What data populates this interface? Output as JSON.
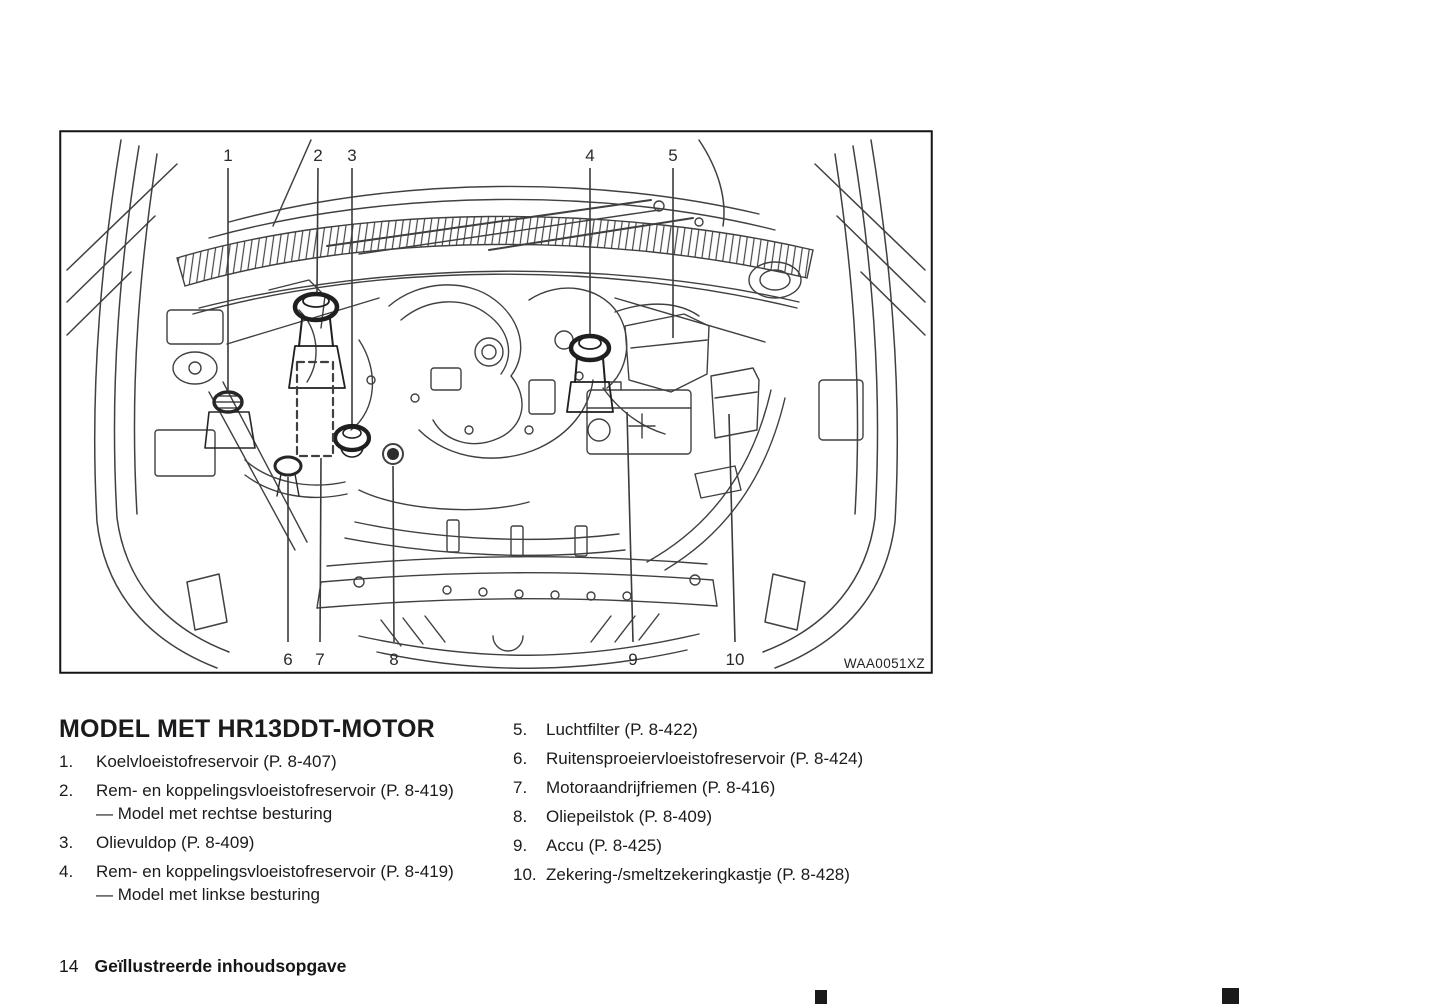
{
  "page": {
    "number": "14",
    "footer_title": "Geïllustreerde inhoudsopgave"
  },
  "figure": {
    "code": "WAA0051XZ",
    "callouts_top": [
      "1",
      "2",
      "3",
      "4",
      "5"
    ],
    "callouts_bottom": [
      "6",
      "7",
      "8",
      "9",
      "10"
    ]
  },
  "section": {
    "heading": "MODEL MET HR13DDT-MOTOR",
    "items_left": [
      {
        "num": "1.",
        "text": "Koelvloeistofreservoir (P. 8-407)"
      },
      {
        "num": "2.",
        "text": "Rem- en koppelingsvloeistofreservoir (P. 8-419)",
        "sub": "— Model met rechtse besturing"
      },
      {
        "num": "3.",
        "text": "Olievuldop (P. 8-409)"
      },
      {
        "num": "4.",
        "text": "Rem- en koppelingsvloeistofreservoir (P. 8-419)",
        "sub": "— Model met linkse besturing"
      }
    ],
    "items_right": [
      {
        "num": "5.",
        "text": "Luchtfilter (P. 8-422)"
      },
      {
        "num": "6.",
        "text": "Ruitensproeiervloeistofreservoir (P. 8-424)"
      },
      {
        "num": "7.",
        "text": "Motoraandrijfriemen (P. 8-416)"
      },
      {
        "num": "8.",
        "text": "Oliepeilstok (P. 8-409)"
      },
      {
        "num": "9.",
        "text": "Accu (P. 8-425)"
      },
      {
        "num": "10.",
        "text": "Zekering-/smeltzekeringkastje (P. 8-428)"
      }
    ]
  },
  "colors": {
    "ink": "#1c1c1e",
    "diagram_line": "#404040",
    "border": "#141414"
  }
}
